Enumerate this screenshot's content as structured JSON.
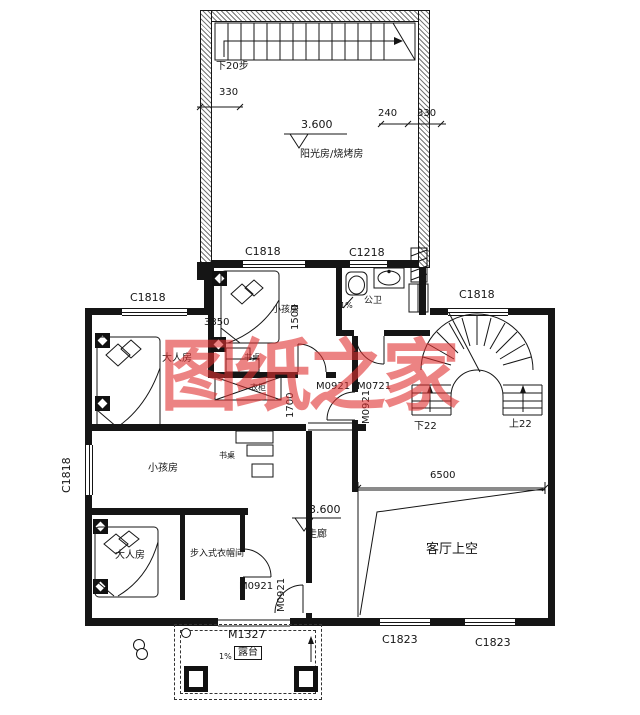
{
  "watermark": "图纸之家",
  "level": "3.600",
  "rooms": {
    "sunroom": "阳光房/烧烤房",
    "bath": "公卫",
    "kids_upper": "小孩房",
    "master_upper": "大人房",
    "desk_upper": "书桌",
    "wardrobe": "衣柜",
    "kids_lower": "小孩房",
    "desk_lower": "书桌",
    "master_lower": "大人房",
    "closet": "步入式衣帽间",
    "corridor": "走廊",
    "living_void": "客厅上空",
    "terrace": "露台"
  },
  "windows": {
    "c1818": "C1818",
    "c1218": "C1218",
    "c1823": "C1823"
  },
  "doors": {
    "m0921": "M0921",
    "m0721": "M0721",
    "m1327": "M1327"
  },
  "stairs": {
    "roof": "下20步",
    "down22": "下22",
    "up22": "上22"
  },
  "dims": {
    "d330": "330",
    "d240": "240",
    "d3850": "3850",
    "d1500": "1500",
    "d1700": "1700",
    "d6500": "6500"
  },
  "slope": "1%"
}
